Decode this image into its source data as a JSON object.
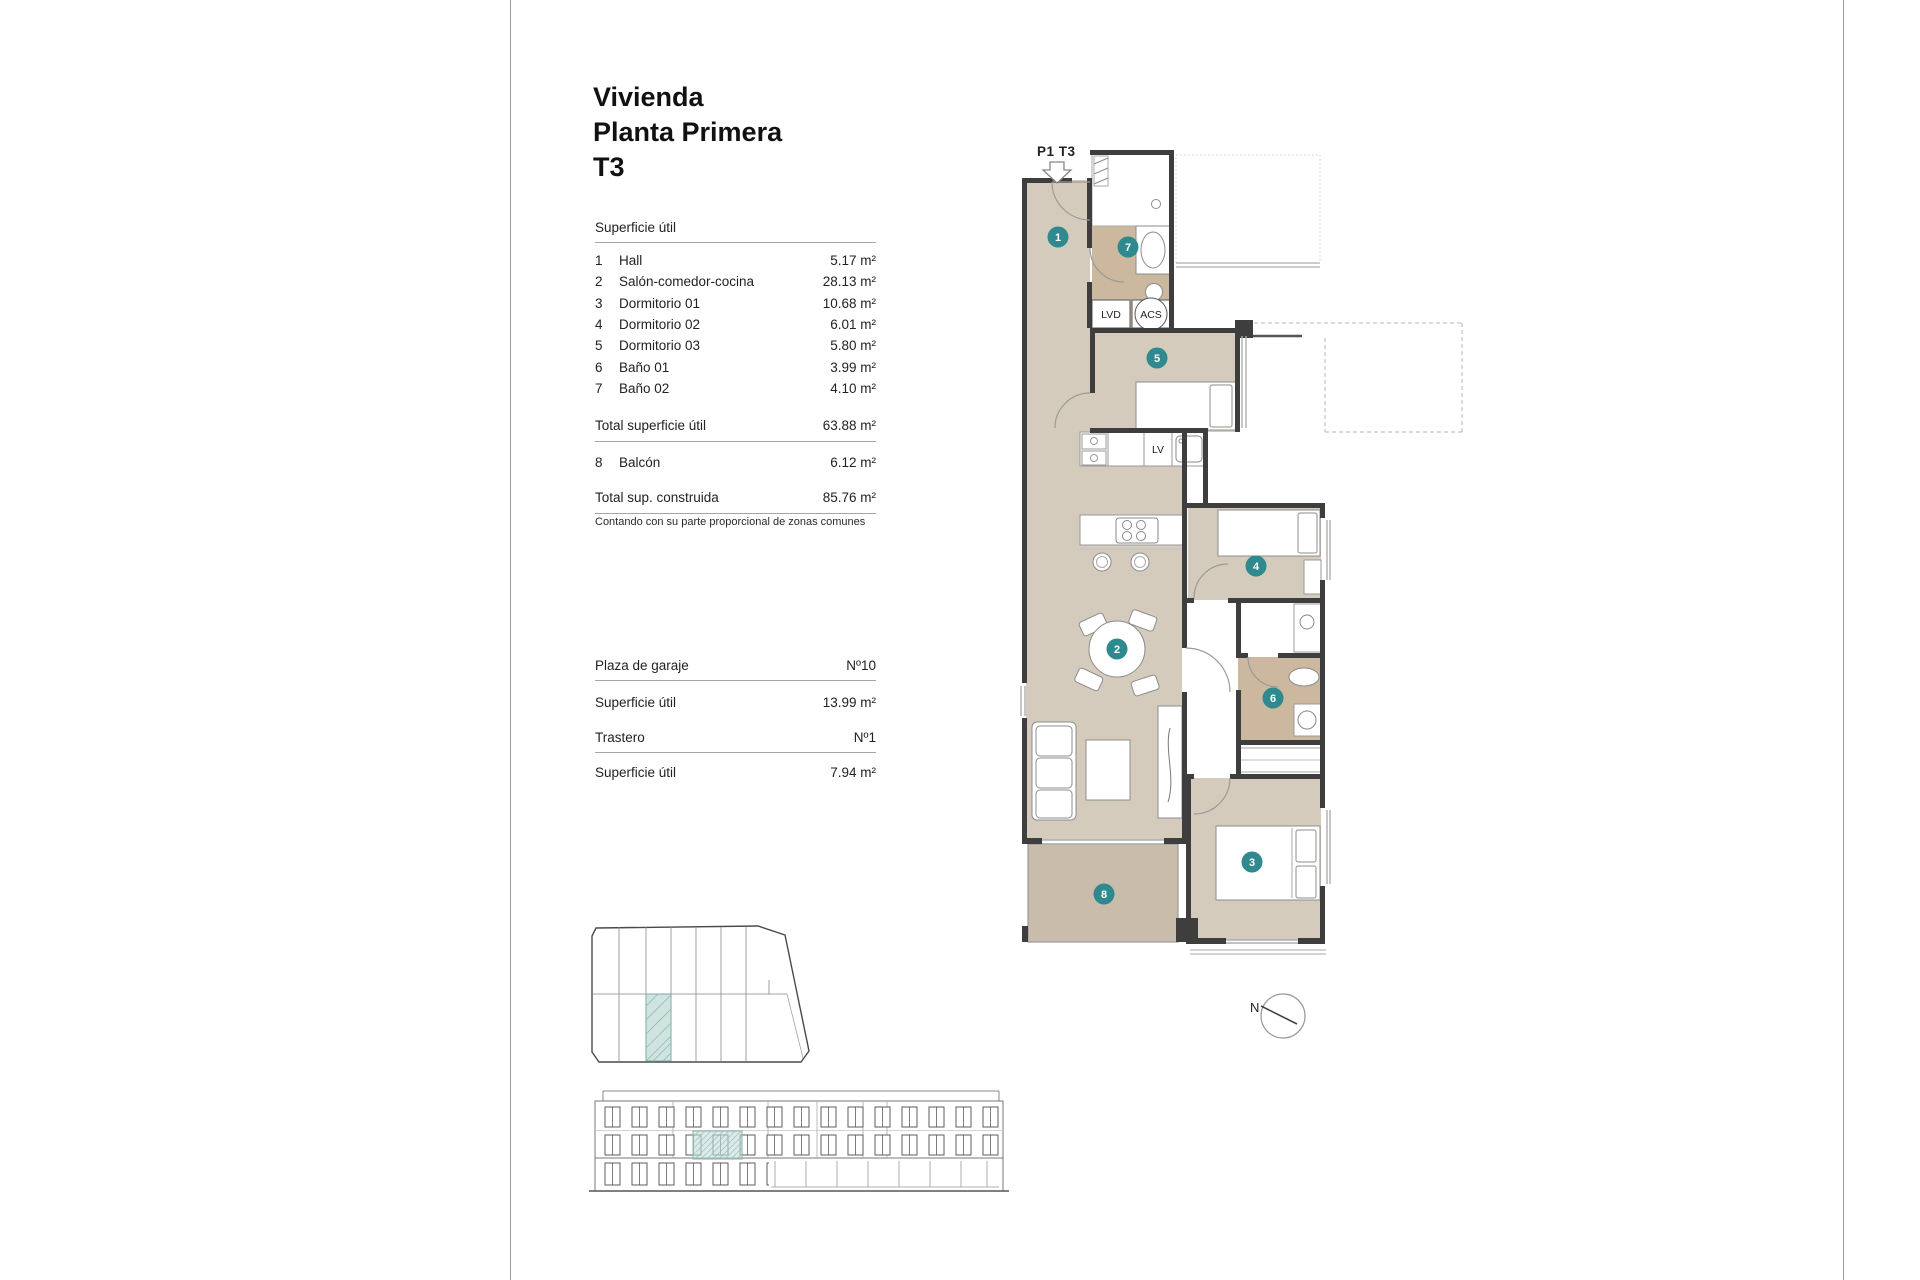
{
  "title": {
    "line1": "Vivienda",
    "line2": "Planta Primera",
    "line3": "T3"
  },
  "surface_table": {
    "header": "Superficie útil",
    "rows": [
      {
        "num": "1",
        "label": "Hall",
        "value": "5.17 m²"
      },
      {
        "num": "2",
        "label": "Salón-comedor-cocina",
        "value": "28.13 m²"
      },
      {
        "num": "3",
        "label": "Dormitorio 01",
        "value": "10.68 m²"
      },
      {
        "num": "4",
        "label": "Dormitorio 02",
        "value": "6.01 m²"
      },
      {
        "num": "5",
        "label": "Dormitorio 03",
        "value": "5.80 m²"
      },
      {
        "num": "6",
        "label": "Baño 01",
        "value": "3.99 m²"
      },
      {
        "num": "7",
        "label": "Baño 02",
        "value": "4.10 m²"
      }
    ],
    "total_util": {
      "label": "Total superficie útil",
      "value": "63.88 m²"
    },
    "balcony_row": {
      "num": "8",
      "label": "Balcón",
      "value": "6.12 m²"
    },
    "total_built": {
      "label": "Total sup. construida",
      "value": "85.76 m²"
    },
    "footnote": "Contando con su parte proporcional de zonas comunes"
  },
  "garage": {
    "label": "Plaza de garaje",
    "number": "Nº10",
    "area_label": "Superficie útil",
    "area_value": "13.99 m²"
  },
  "storage": {
    "label": "Trastero",
    "number": "Nº1",
    "area_label": "Superficie útil",
    "area_value": "7.94 m²"
  },
  "floor_plan": {
    "unit_label": "P1 T3",
    "badges": [
      "1",
      "2",
      "3",
      "4",
      "5",
      "6",
      "7",
      "8"
    ],
    "appliance_labels": {
      "lvd": "LVD",
      "acs": "ACS",
      "lv": "LV"
    },
    "compass": "N"
  },
  "colors": {
    "room_tan": "#d5cbbd",
    "bath_tan": "#ccb89e",
    "balcony_tan": "#c9bcaa",
    "wall": "#3e3e3e",
    "badge_teal": "#2e8a8e",
    "highlight_teal": "#cfe3df"
  }
}
